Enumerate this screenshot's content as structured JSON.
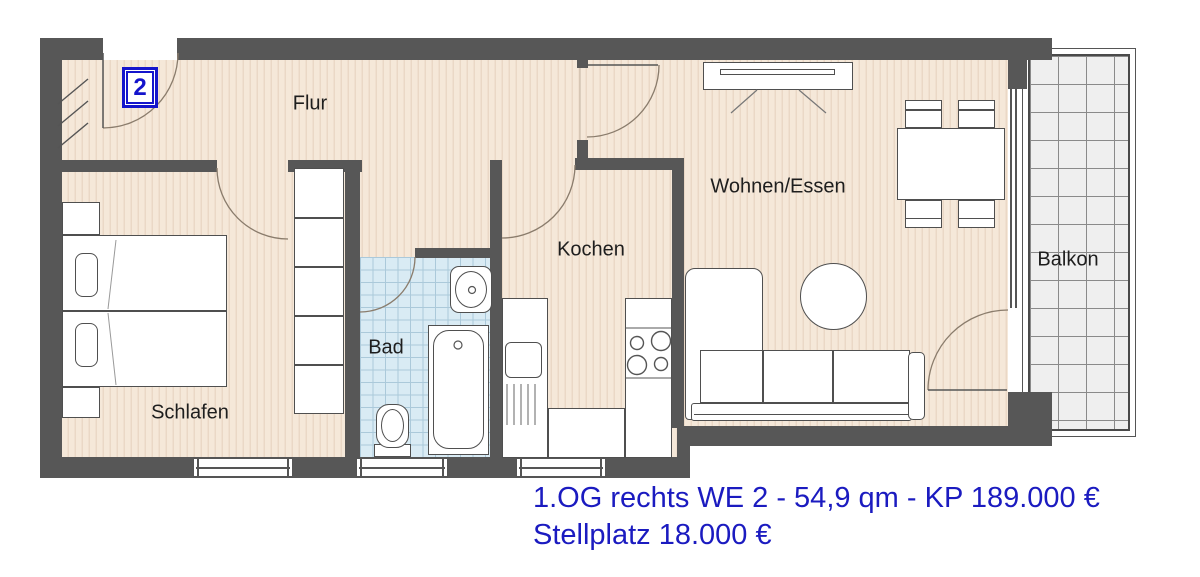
{
  "floorplan": {
    "unit_badge": "2",
    "rooms": {
      "flur": "Flur",
      "schlafen": "Schlafen",
      "bad": "Bad",
      "kochen": "Kochen",
      "wohnen_essen": "Wohnen/Essen",
      "balkon": "Balkon"
    },
    "caption": {
      "line1": "1.OG rechts WE 2 - 54,9 qm - KP 189.000 €",
      "line2": "Stellplatz 18.000 €"
    },
    "colors": {
      "wall_gray": "#575757",
      "floor_cream": "#f5e8d9",
      "floor_stripe": "#ead8c6",
      "bath_tile_blue": "#d9ebf4",
      "bath_tile_line": "#abc9da",
      "balcony_tile_gray": "#efefef",
      "caption_blue": "#1b1bc0",
      "badge_blue": "#1414cc",
      "room_label_color": "#1e1e1e"
    }
  }
}
